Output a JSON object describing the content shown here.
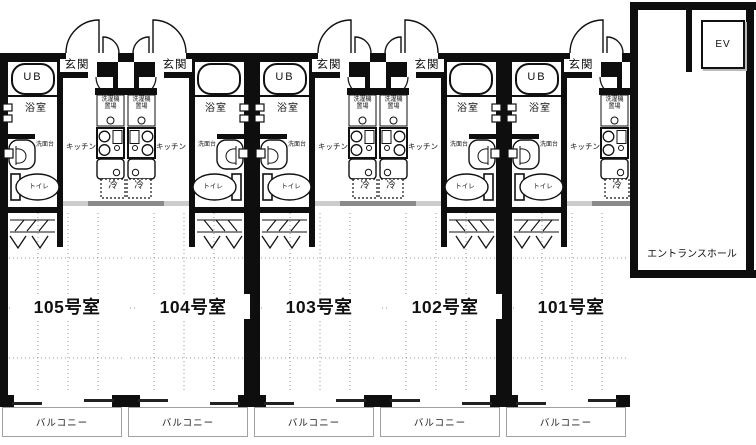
{
  "floorplan": {
    "type": "apartment-floor-plan",
    "units": [
      {
        "id": "105",
        "room_label": "105号室",
        "mirrored": false,
        "ub_label": "UB"
      },
      {
        "id": "104",
        "room_label": "104号室",
        "mirrored": true,
        "ub_label": ""
      },
      {
        "id": "103",
        "room_label": "103号室",
        "mirrored": false,
        "ub_label": "UB"
      },
      {
        "id": "102",
        "room_label": "102号室",
        "mirrored": true,
        "ub_label": ""
      },
      {
        "id": "101",
        "room_label": "101号室",
        "mirrored": false,
        "ub_label": "UB"
      }
    ],
    "room_labels": {
      "genkan": "玄関",
      "bathroom": "浴室",
      "washstand": "洗面台",
      "toilet": "トイレ",
      "kitchen": "キッチン",
      "laundry_line1": "洗濯機",
      "laundry_line2": "置場",
      "fridge": "冷",
      "balcony": "バルコニー"
    },
    "entrance_hall": {
      "label": "エントランスホール",
      "elevator_label": "EV"
    },
    "colors": {
      "wall": "#0e0e0e",
      "line": "#111111",
      "grid_dots": "#999999",
      "slider_dark": "#8a8a8a",
      "slider_light": "#cccccc",
      "balcony_border": "#a0a0a0",
      "background": "#ffffff"
    }
  }
}
